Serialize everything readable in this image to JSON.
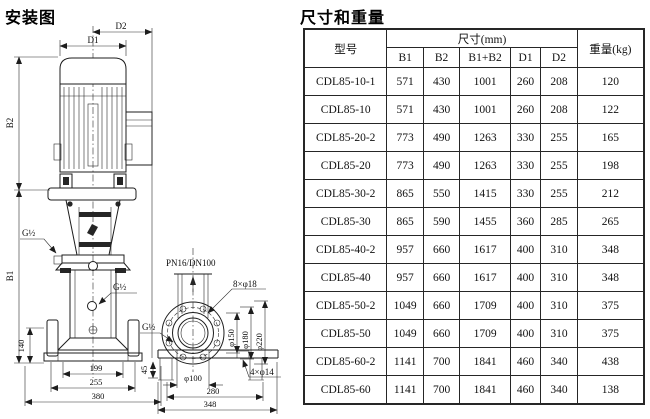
{
  "installation": {
    "title": "安装图",
    "labels": {
      "d1": "D1",
      "d2": "D2",
      "b1": "B1",
      "b2": "B2",
      "g_half_left": "G½",
      "g_half_mid": "G½",
      "g_half_side": "G½",
      "dim_140": "140",
      "dim_199": "199",
      "dim_255": "255",
      "dim_380": "380",
      "dim_45": "45",
      "dim_280": "280",
      "dim_348": "348",
      "flange_spec": "PN16/DN100",
      "bolt_holes_8": "8×φ18",
      "anchor_holes_4": "4×φ14",
      "phi_150": "φ150",
      "phi_180": "φ180",
      "phi_220": "φ220",
      "phi_100": "φ100"
    }
  },
  "dimensions_table": {
    "title": "尺寸和重量",
    "header": {
      "model": "型号",
      "size_group": "尺寸(mm)",
      "weight": "重量(kg)",
      "sub_columns": [
        "B1",
        "B2",
        "B1+B2",
        "D1",
        "D2"
      ]
    },
    "rows": [
      [
        "CDL85-10-1",
        "571",
        "430",
        "1001",
        "260",
        "208",
        "120"
      ],
      [
        "CDL85-10",
        "571",
        "430",
        "1001",
        "260",
        "208",
        "122"
      ],
      [
        "CDL85-20-2",
        "773",
        "490",
        "1263",
        "330",
        "255",
        "165"
      ],
      [
        "CDL85-20",
        "773",
        "490",
        "1263",
        "330",
        "255",
        "198"
      ],
      [
        "CDL85-30-2",
        "865",
        "550",
        "1415",
        "330",
        "255",
        "212"
      ],
      [
        "CDL85-30",
        "865",
        "590",
        "1455",
        "360",
        "285",
        "265"
      ],
      [
        "CDL85-40-2",
        "957",
        "660",
        "1617",
        "400",
        "310",
        "348"
      ],
      [
        "CDL85-40",
        "957",
        "660",
        "1617",
        "400",
        "310",
        "348"
      ],
      [
        "CDL85-50-2",
        "1049",
        "660",
        "1709",
        "400",
        "310",
        "375"
      ],
      [
        "CDL85-50",
        "1049",
        "660",
        "1709",
        "400",
        "310",
        "375"
      ],
      [
        "CDL85-60-2",
        "1141",
        "700",
        "1841",
        "460",
        "340",
        "438"
      ],
      [
        "CDL85-60",
        "1141",
        "700",
        "1841",
        "460",
        "340",
        "138"
      ]
    ]
  },
  "colors": {
    "line": "#1d1d1d",
    "background": "#ffffff",
    "text": "#111111"
  }
}
